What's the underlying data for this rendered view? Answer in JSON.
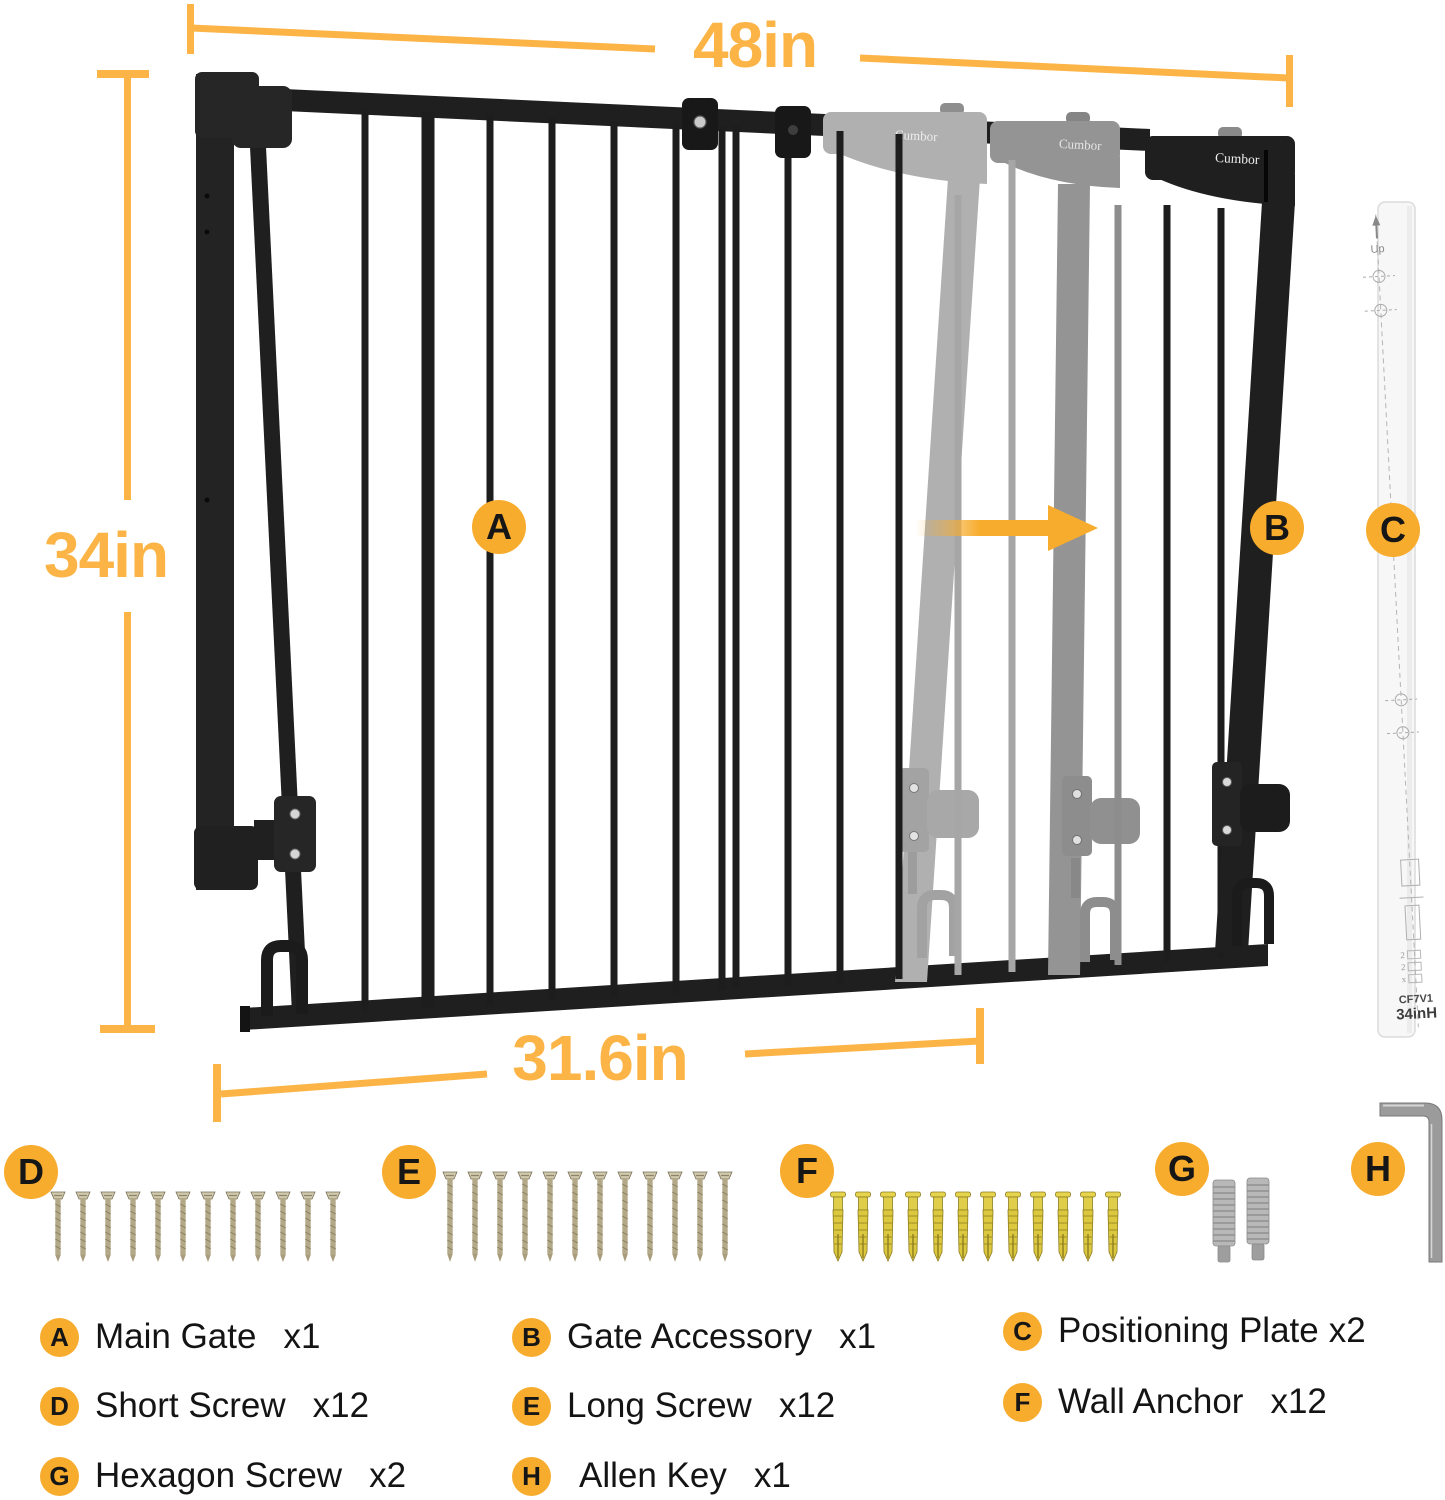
{
  "colors": {
    "accent": "#F7AC2E",
    "dim_yellow": "#FBB445",
    "gate_black": "#1f1f1f",
    "ghost_light": "#b0b0b0",
    "ghost_mid": "#949494",
    "screw_tan": "#b3a887",
    "anchor_gold": "#e0ce4a",
    "stud_silver": "#b8b8b8",
    "plate_white": "#f7f7f7"
  },
  "dimensions": {
    "top_width": "48in",
    "left_height": "34in",
    "bottom_width": "31.6in"
  },
  "diagram_badges": {
    "a": "A",
    "b": "B",
    "c": "C",
    "d": "D",
    "e": "E",
    "f": "F",
    "g": "G",
    "h": "H"
  },
  "brand_marks": {
    "ghost1": "Cumbor",
    "ghost2": "Cumbor",
    "solid": "Cumbor"
  },
  "plate": {
    "up": "Up",
    "marks": [
      "2",
      "2",
      "x"
    ],
    "model": "CF7V1",
    "size": "34inH"
  },
  "legend": [
    {
      "badge": "A",
      "label": "Main Gate",
      "count": "x1"
    },
    {
      "badge": "B",
      "label": "Gate Accessory",
      "count": "x1"
    },
    {
      "badge": "C",
      "label": "Positioning Plate",
      "count": "x2"
    },
    {
      "badge": "D",
      "label": "Short Screw",
      "count": "x12"
    },
    {
      "badge": "E",
      "label": "Long Screw",
      "count": "x12"
    },
    {
      "badge": "F",
      "label": "Wall Anchor",
      "count": "x12"
    },
    {
      "badge": "G",
      "label": "Hexagon Screw",
      "count": "x2"
    },
    {
      "badge": "H",
      "label": "Allen Key",
      "count": "x1"
    }
  ]
}
